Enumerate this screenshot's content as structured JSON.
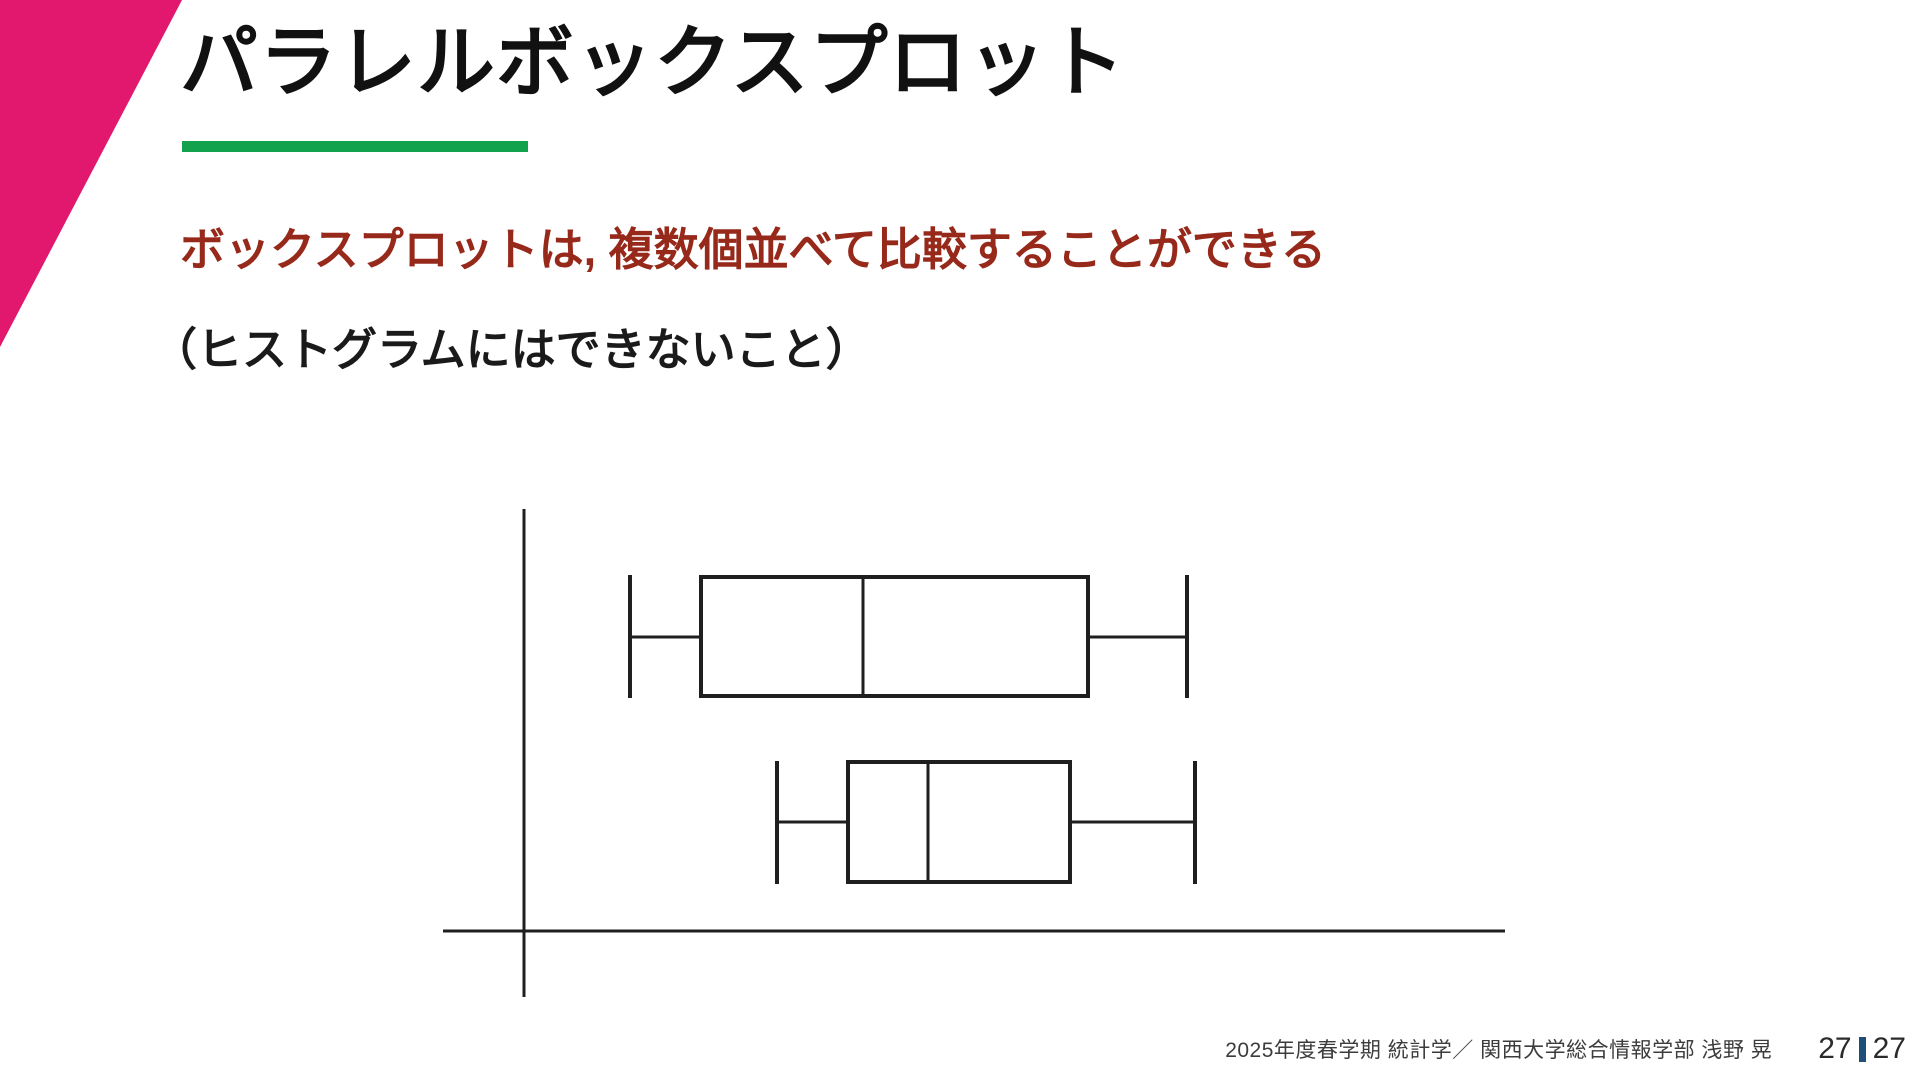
{
  "slide": {
    "title": "パラレルボックスプロット",
    "lead": "ボックスプロットは, 複数個並べて比較することができる",
    "sub": "（ヒストグラムにはできないこと）",
    "accent_pink": "#e2176e",
    "accent_green": "#12a24d",
    "lead_color": "#97291b"
  },
  "footer": {
    "credit": "2025年度春学期  統計学／ 関西大学総合情報学部 浅野 晃",
    "page_current": "27",
    "page_total": "27",
    "separator_color": "#1f4e79"
  },
  "diagram": {
    "type": "parallel-boxplot-illustration",
    "stroke_color": "#1f1f1f",
    "axis_width": 3,
    "line_width": 3,
    "box_width": 4,
    "v_axis": {
      "x": 524,
      "y1": 509,
      "y2": 997
    },
    "h_axis": {
      "y": 931,
      "x1": 443,
      "x2": 1505
    },
    "boxplots": [
      {
        "name": "boxplot-1",
        "whisker_min_x": 630,
        "box_left": 701,
        "median_x": 863,
        "box_right": 1088,
        "whisker_max_x": 1187,
        "box_top": 577,
        "box_bottom": 696,
        "cap_top": 575,
        "cap_bottom": 698,
        "whisker_y": 637
      },
      {
        "name": "boxplot-2",
        "whisker_min_x": 777,
        "box_left": 848,
        "median_x": 928,
        "box_right": 1070,
        "whisker_max_x": 1195,
        "box_top": 762,
        "box_bottom": 882,
        "cap_top": 761,
        "cap_bottom": 884,
        "whisker_y": 822
      }
    ]
  }
}
